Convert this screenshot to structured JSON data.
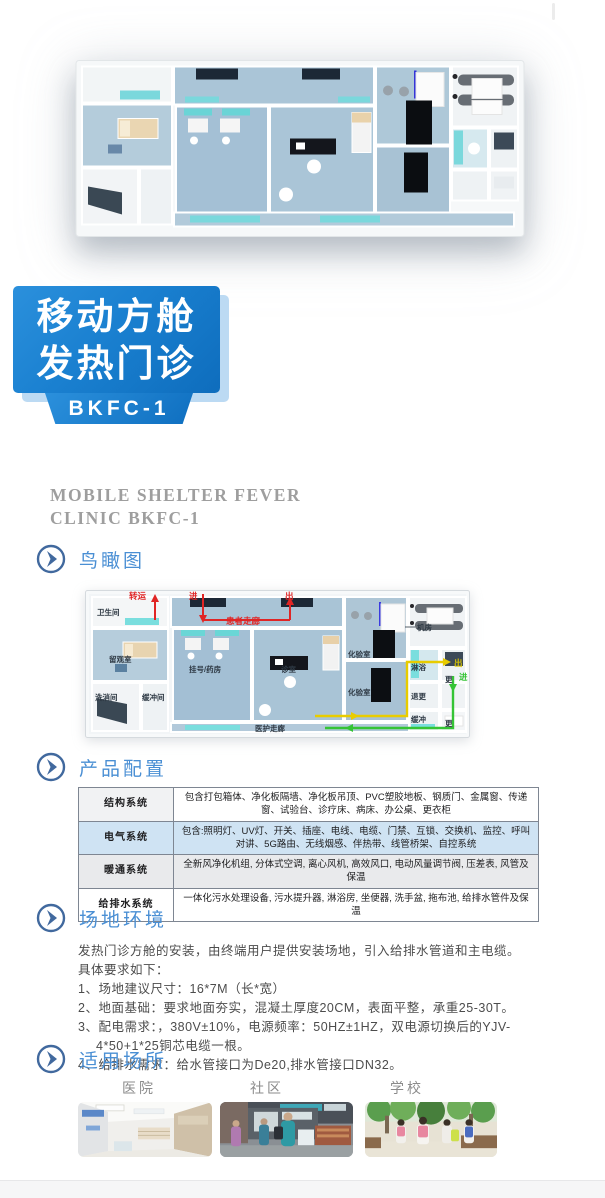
{
  "banner": {
    "line1": "移动方舱",
    "line2": "发热门诊",
    "model": "BKFC-1",
    "bg_color": "#1a80d0",
    "shadow_color": "#bcdaf3"
  },
  "subtitle": {
    "line1": "MOBILE SHELTER FEVER",
    "line2": "CLINIC  BKFC-1"
  },
  "accent_color": "#4a8fd4",
  "sections": {
    "aerial": {
      "title": "鸟瞰图"
    },
    "config": {
      "title": "产品配置"
    },
    "site": {
      "title": "场地环境"
    },
    "places": {
      "title": "适用场所"
    }
  },
  "floorplan": {
    "toilet": "卫生间",
    "observation": "留观室",
    "washing": "洗消间",
    "buffer_room": "缓冲间",
    "patient_corridor": "患者走廊",
    "registration": "挂号/药房",
    "consult_room": "诊室",
    "lab_upper": "化验室",
    "lab_lower": "化验室",
    "machine_room": "机房",
    "shower": "淋浴",
    "change_out": "退更",
    "buffer_small": "缓冲",
    "staff_corridor": "医护走廊",
    "change_mid": "更",
    "change_bottom": "更",
    "transfer": "转运",
    "enter_main": "进",
    "exit_main": "出",
    "exit_staff": "出",
    "enter_staff": "进"
  },
  "config_table": {
    "rows": [
      {
        "label": "结构系统",
        "content": "包含打包箱体、净化板隔墙、净化板吊顶、PVC塑胶地板、钢质门、金属窗、传递窗、试验台、诊疗床、病床、办公桌、更衣柜"
      },
      {
        "label": "电气系统",
        "content": "包含:照明灯、UV灯、开关、插座、电线、电缆、门禁、互锁、交换机、监控、呼叫对讲、5G路由、无线烟感、伴热带、线管桥架、自控系统"
      },
      {
        "label": "暖通系统",
        "content": "全新风净化机组, 分体式空调, 离心风机, 高效风口, 电动风量调节阀, 压差表, 风管及保温"
      },
      {
        "label": "给排水系统",
        "content": "一体化污水处理设备, 污水提升器, 淋浴房, 坐便器, 洗手盆, 拖布池, 给排水管件及保温"
      }
    ]
  },
  "site_env": {
    "intro": "发热门诊方舱的安装，由终端用户提供安装场地，引入给排水管道和主电缆。",
    "subintro": "具体要求如下：",
    "items": [
      "1、场地建议尺寸：16*7M（长*宽）",
      "2、地面基础：要求地面夯实，混凝土厚度20CM，表面平整，承重25-30T。",
      "3、配电需求：，380V±10%，电源频率：50HZ±1HZ，双电源切换后的YJV-4*50+1*25铜芯电缆一根。",
      "4、给排水需求：给水管接口为De20,排水管接口DN32。"
    ]
  },
  "places": {
    "items": [
      {
        "label": "医院"
      },
      {
        "label": "社区"
      },
      {
        "label": "学校"
      }
    ]
  }
}
